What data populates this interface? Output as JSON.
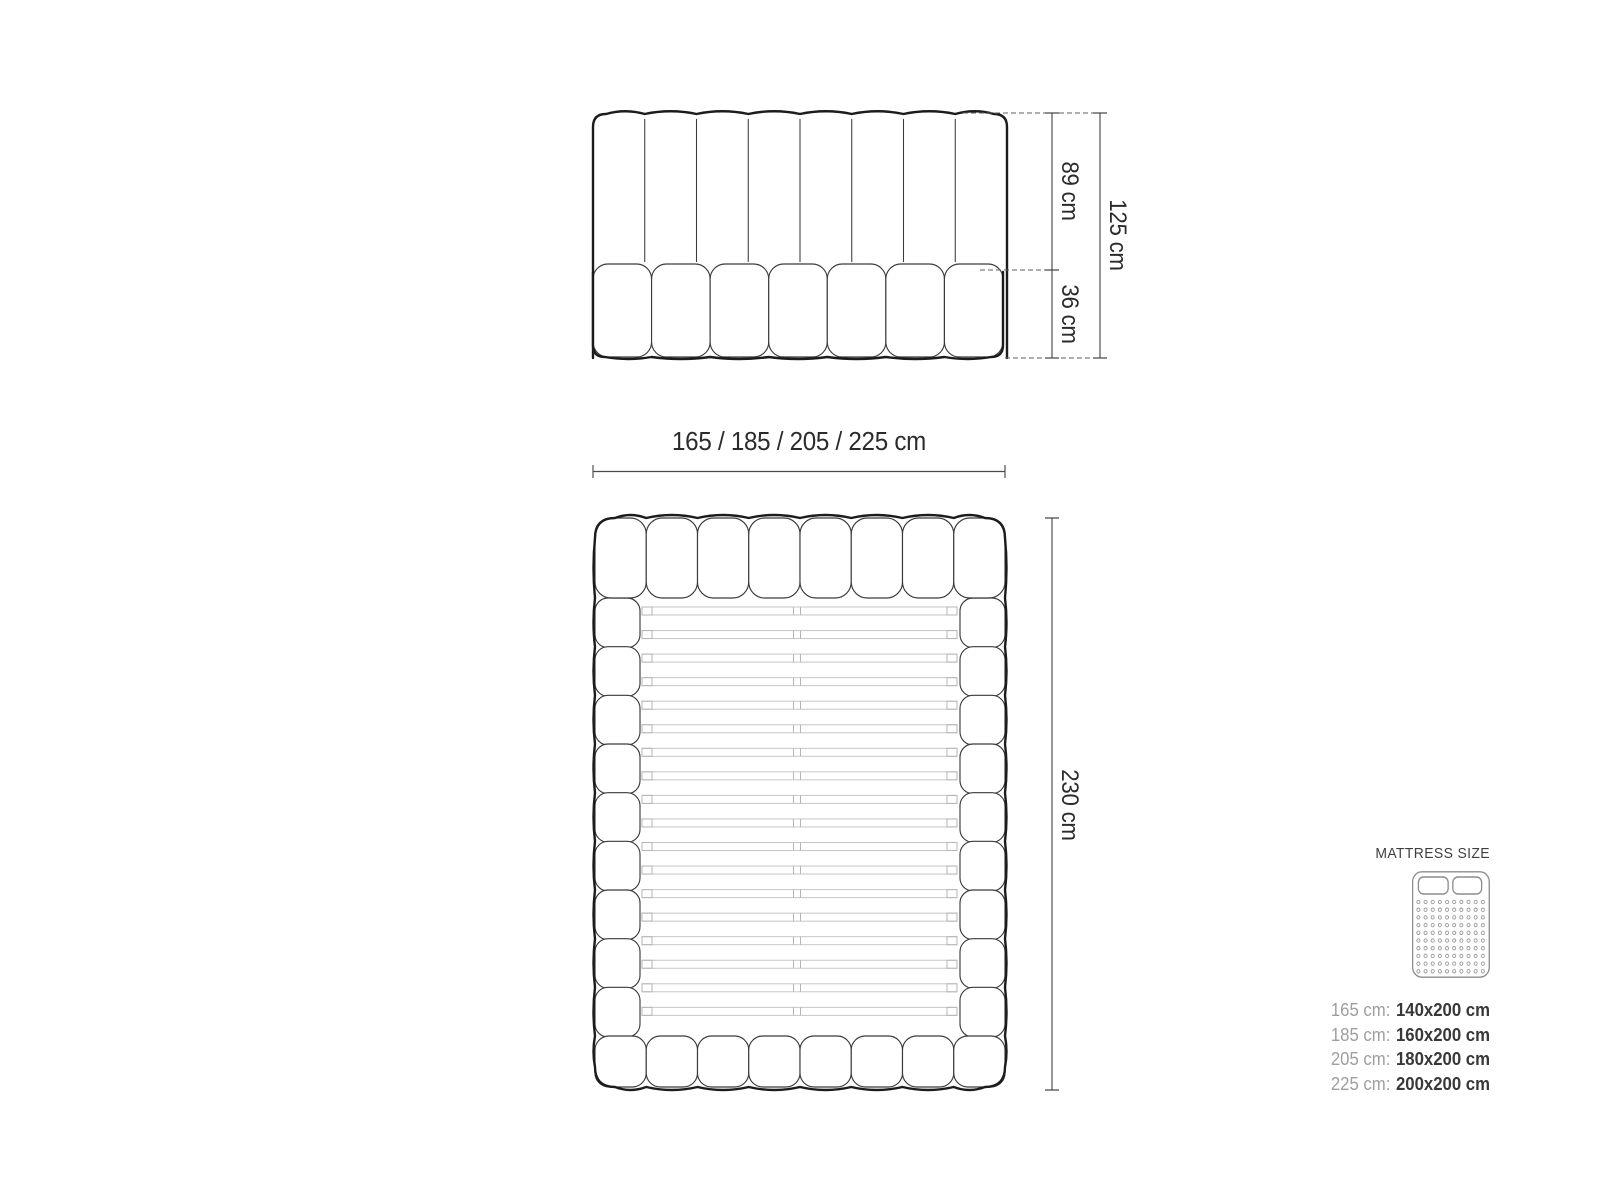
{
  "front_view": {
    "height_upper": "89 cm",
    "height_lower": "36 cm",
    "height_total": "125 cm"
  },
  "top_view": {
    "width_options": "165 / 185 / 205 / 225 cm",
    "length": "230 cm"
  },
  "legend": {
    "title": "MATTRESS SIZE",
    "icon": {
      "pillows": 2,
      "dot_rows": 10,
      "dot_cols": 10
    },
    "sizes": [
      {
        "label": "165 cm:",
        "value": "140x200 cm"
      },
      {
        "label": "185 cm:",
        "value": "160x200 cm"
      },
      {
        "label": "205 cm:",
        "value": "180x200 cm"
      },
      {
        "label": "225 cm:",
        "value": "200x200 cm"
      }
    ]
  },
  "diagram": {
    "front_view": {
      "headboard_channels": 8,
      "mattress_cushions": 7
    },
    "top_view": {
      "header_cushions": 8,
      "footer_cushions": 8,
      "side_cushions_per_side": 9,
      "slats": 18
    }
  },
  "colors": {
    "background": "#ffffff",
    "outline_bold": "#1c1c1c",
    "outline_thin": "#3a3a3a",
    "slat_line": "#c6c6c6",
    "slat_cap": "#b5b5b5",
    "dimension_line": "#4a4a4a",
    "dashed_line": "#5f5f5f",
    "dim_text": "#2b2b2b",
    "legend_title": "#3f3f3f",
    "legend_label": "#9e9e9e",
    "legend_value": "#383838",
    "icon_stroke": "#8c8c8c",
    "icon_dot": "#9a9a9a"
  }
}
